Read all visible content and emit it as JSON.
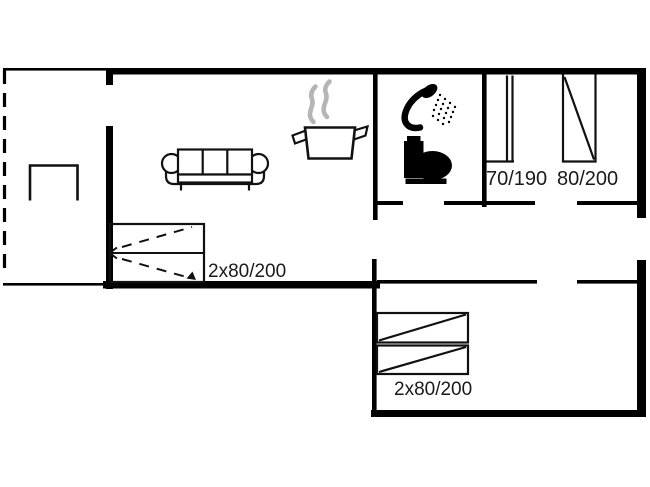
{
  "plan": {
    "type": "floor-plan",
    "background": "#ffffff",
    "wall_color": "#000000",
    "steam_color": "#b5b5b5",
    "label_color": "#1a1a1a",
    "labels": {
      "bed_small_single": "70/190",
      "bed_single": "80/200",
      "bed_double_living": "2x80/200",
      "bed_double_room": "2x80/200"
    },
    "icons": [
      "table-icon",
      "sofa-icon",
      "cooking-pot-icon",
      "steam-icon",
      "shower-icon",
      "toilet-icon",
      "bed-70x190-icon",
      "bed-80x200-icon",
      "sofa-bed-2x80x200-icon",
      "double-bed-2x80x200-icon"
    ]
  }
}
